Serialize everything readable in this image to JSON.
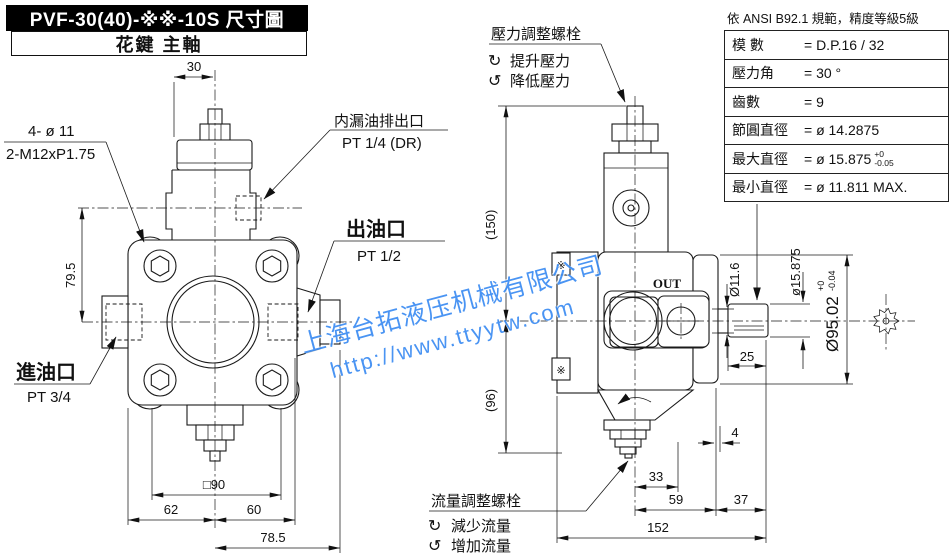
{
  "title": {
    "model": "PVF-30(40)-※※-10S 尺寸圖",
    "subtitle": "花鍵 主軸"
  },
  "watermark": {
    "line1": "上海台拓液压机械有限公司",
    "line2": "http://www.ttyytw.com",
    "color": "#3b8cf2"
  },
  "spec_table": {
    "note": "依 ANSI B92.1 規範，精度等級5級",
    "rows": [
      {
        "label": "模 數",
        "value": "= D.P.16 / 32"
      },
      {
        "label": "壓力角",
        "value": "= 30 °"
      },
      {
        "label": "齒數",
        "value": "= 9"
      },
      {
        "label": "節圓直徑",
        "value": "= ø 14.2875"
      },
      {
        "label": "最大直徑",
        "value": "= ø 15.875",
        "tol_top": "+0",
        "tol_bottom": "-0.05"
      },
      {
        "label": "最小直徑",
        "value": "= ø 11.811 MAX."
      }
    ]
  },
  "adjusters": {
    "cw_icon": "↻",
    "ccw_icon": "↺",
    "pressure": {
      "title": "壓力調整螺栓",
      "cw": "提升壓力",
      "ccw": "降低壓力"
    },
    "flow": {
      "title": "流量調整螺栓",
      "cw": "減少流量",
      "ccw": "增加流量"
    }
  },
  "front_view": {
    "holes_label_1": "4- ø 11",
    "holes_label_2": "2-M12xP1.75",
    "drain_name": "内漏油排出口",
    "drain_size": "PT 1/4 (DR)",
    "outlet_name": "出油口",
    "outlet_size": "PT 1/2",
    "inlet_name": "進油口",
    "inlet_size": "PT 3/4",
    "dims": {
      "top_width": "30",
      "upper_height": "79.5",
      "square": "□90",
      "left": "62",
      "right": "60",
      "outlet_face": "78.5"
    }
  },
  "side_view": {
    "out_port": "OUT",
    "section_mark": "※",
    "dims": {
      "upper_height": "(150)",
      "lower_height": "(96)",
      "shaft_step_dia": "Ø11.6",
      "shaft_dia": "ø15.875",
      "pilot_dia": "Ø95.02",
      "pilot_tol_top": "+0",
      "pilot_tol_bot": "-0.04",
      "shaft_len": "25",
      "gap": "4",
      "d33": "33",
      "d59": "59",
      "d37": "37",
      "total": "152"
    }
  }
}
